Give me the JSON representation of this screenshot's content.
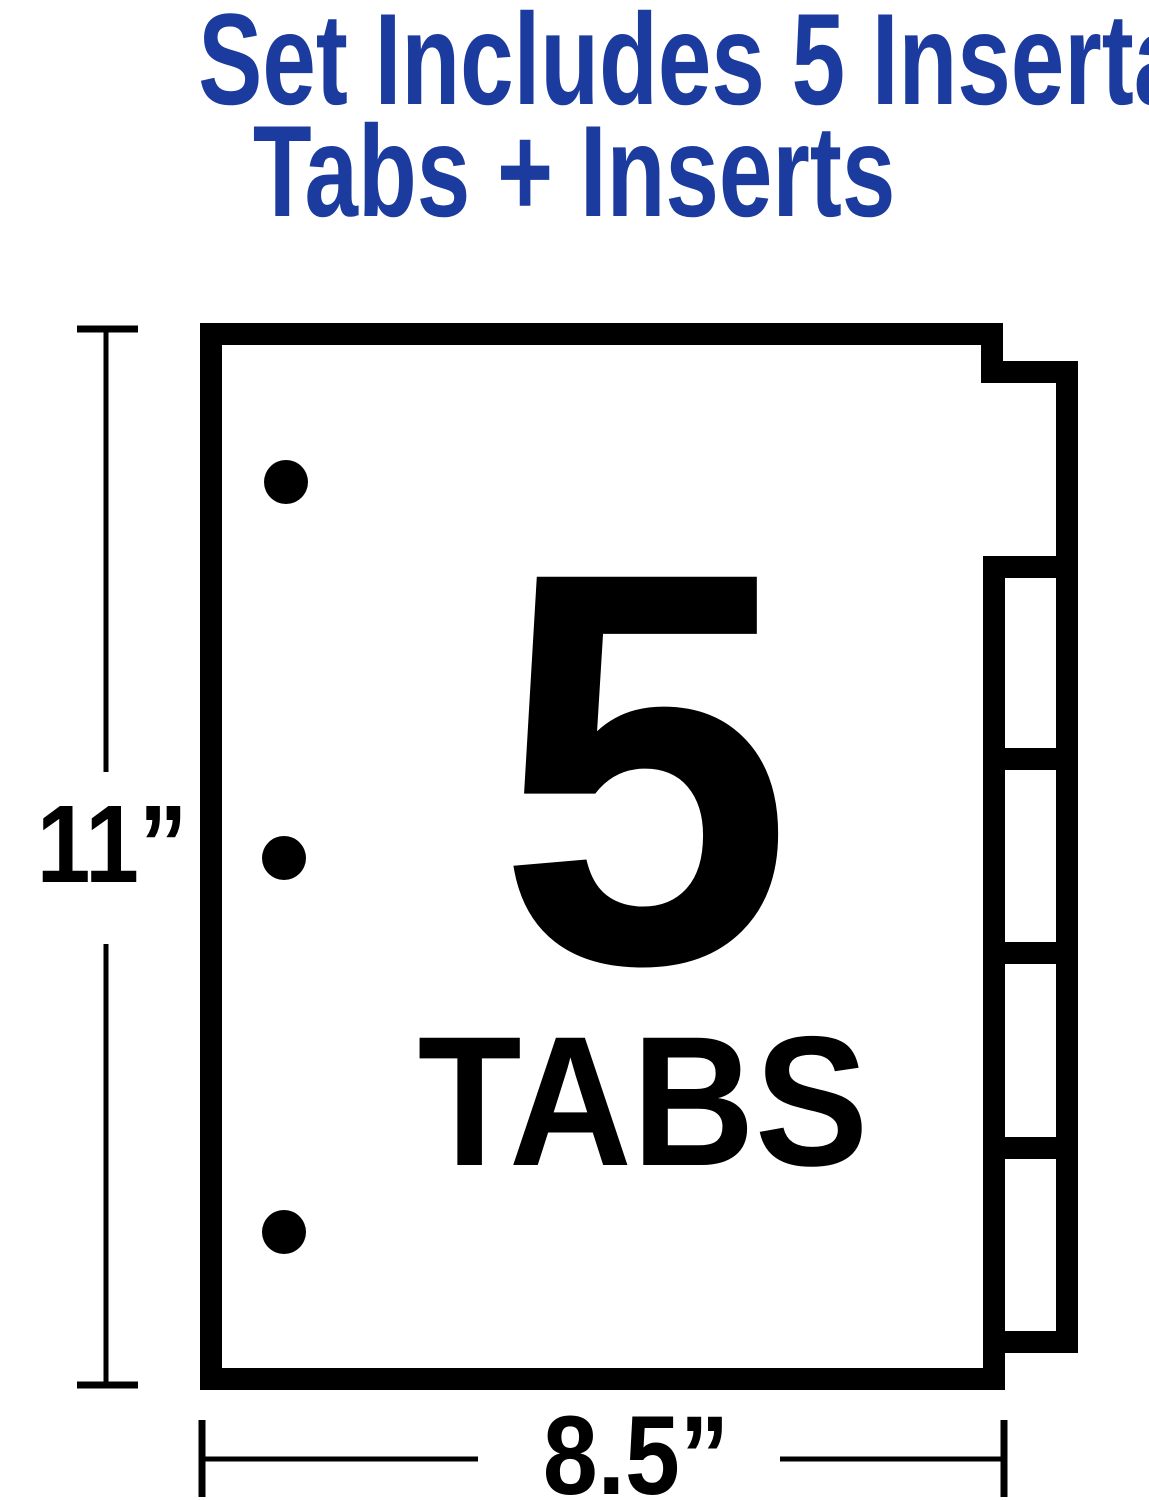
{
  "heading": {
    "line1": "Set Includes 5 Insertable",
    "line2": "Tabs + Inserts",
    "color": "#1c3b9e"
  },
  "diagram": {
    "tab_count_number": "5",
    "tab_count_label": "TABS",
    "tabs_total": 5,
    "height_label": "11”",
    "width_label": "8.5”",
    "outline_color": "#000000",
    "sheet_fill": "#ffffff",
    "hole_count": 3
  }
}
